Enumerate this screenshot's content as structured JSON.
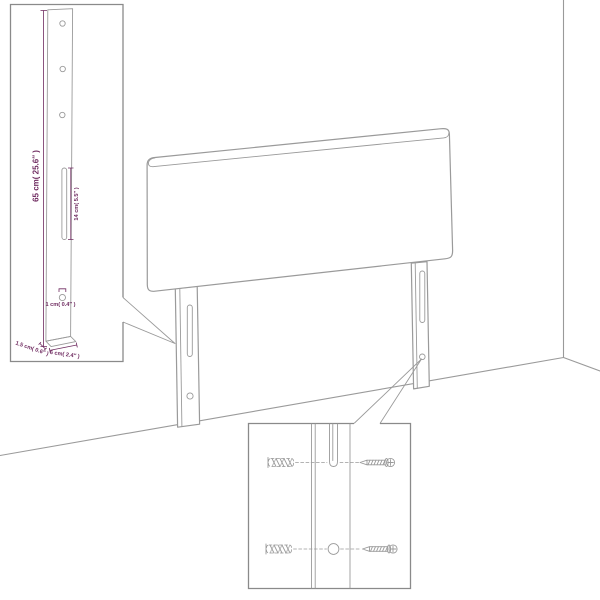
{
  "figure": {
    "kind": "furniture-assembly-diagram",
    "subject": "upholstered headboard with two wall-mount legs",
    "views": [
      "room-perspective",
      "leg-dimension-inset",
      "wall-mounting-inset"
    ]
  },
  "colors": {
    "background": "#ffffff",
    "line_art": "#9a9a9a",
    "inset_border": "#8a8a8a",
    "dimension": "#6f2b60"
  },
  "leg_inset": {
    "dim_height": "65 cm( 25.6″ )",
    "dim_slot": "14 cm( 5.5″ )",
    "dim_hole": "1 cm( 0.4″ )",
    "dim_thickness": "1.5 cm( 0.6″ )",
    "dim_width": "6 cm( 2.4″ )"
  },
  "mount_inset": {
    "left_part_icon": "wall-plug-icon",
    "right_part_icon": "screw-icon",
    "rows": 2
  }
}
